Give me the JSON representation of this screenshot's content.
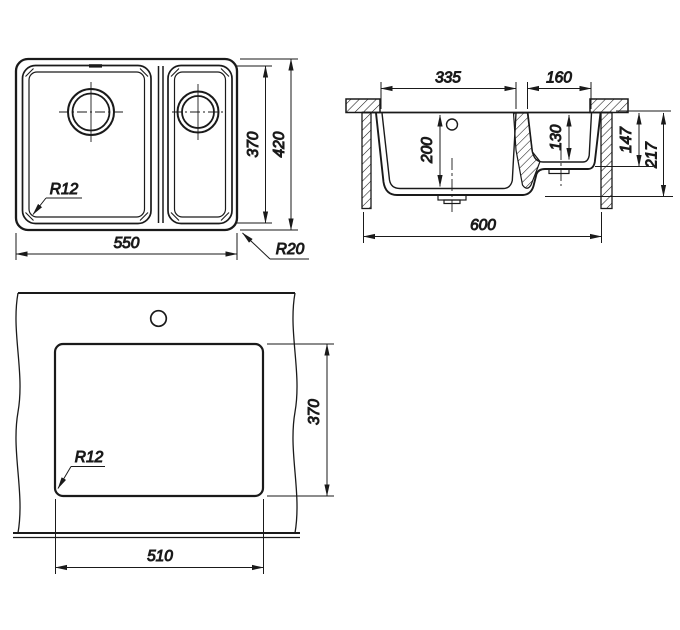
{
  "colors": {
    "ink": "#1a1a1a",
    "background": "#ffffff"
  },
  "views": {
    "plan": {
      "labels": {
        "overall_width": "550",
        "bowl_height": "370",
        "overall_height": "420",
        "inner_corner_radius": "R12",
        "outer_corner_radius": "R20"
      }
    },
    "section": {
      "labels": {
        "main_bowl_width": "335",
        "second_bowl_width": "160",
        "main_bowl_depth": "200",
        "second_bowl_depth": "130",
        "depth_to_second_bowl_bottom": "147",
        "overall_depth": "217",
        "cabinet_width": "600"
      }
    },
    "cutout": {
      "labels": {
        "cutout_width": "510",
        "cutout_height": "370",
        "corner_radius": "R12"
      }
    }
  }
}
